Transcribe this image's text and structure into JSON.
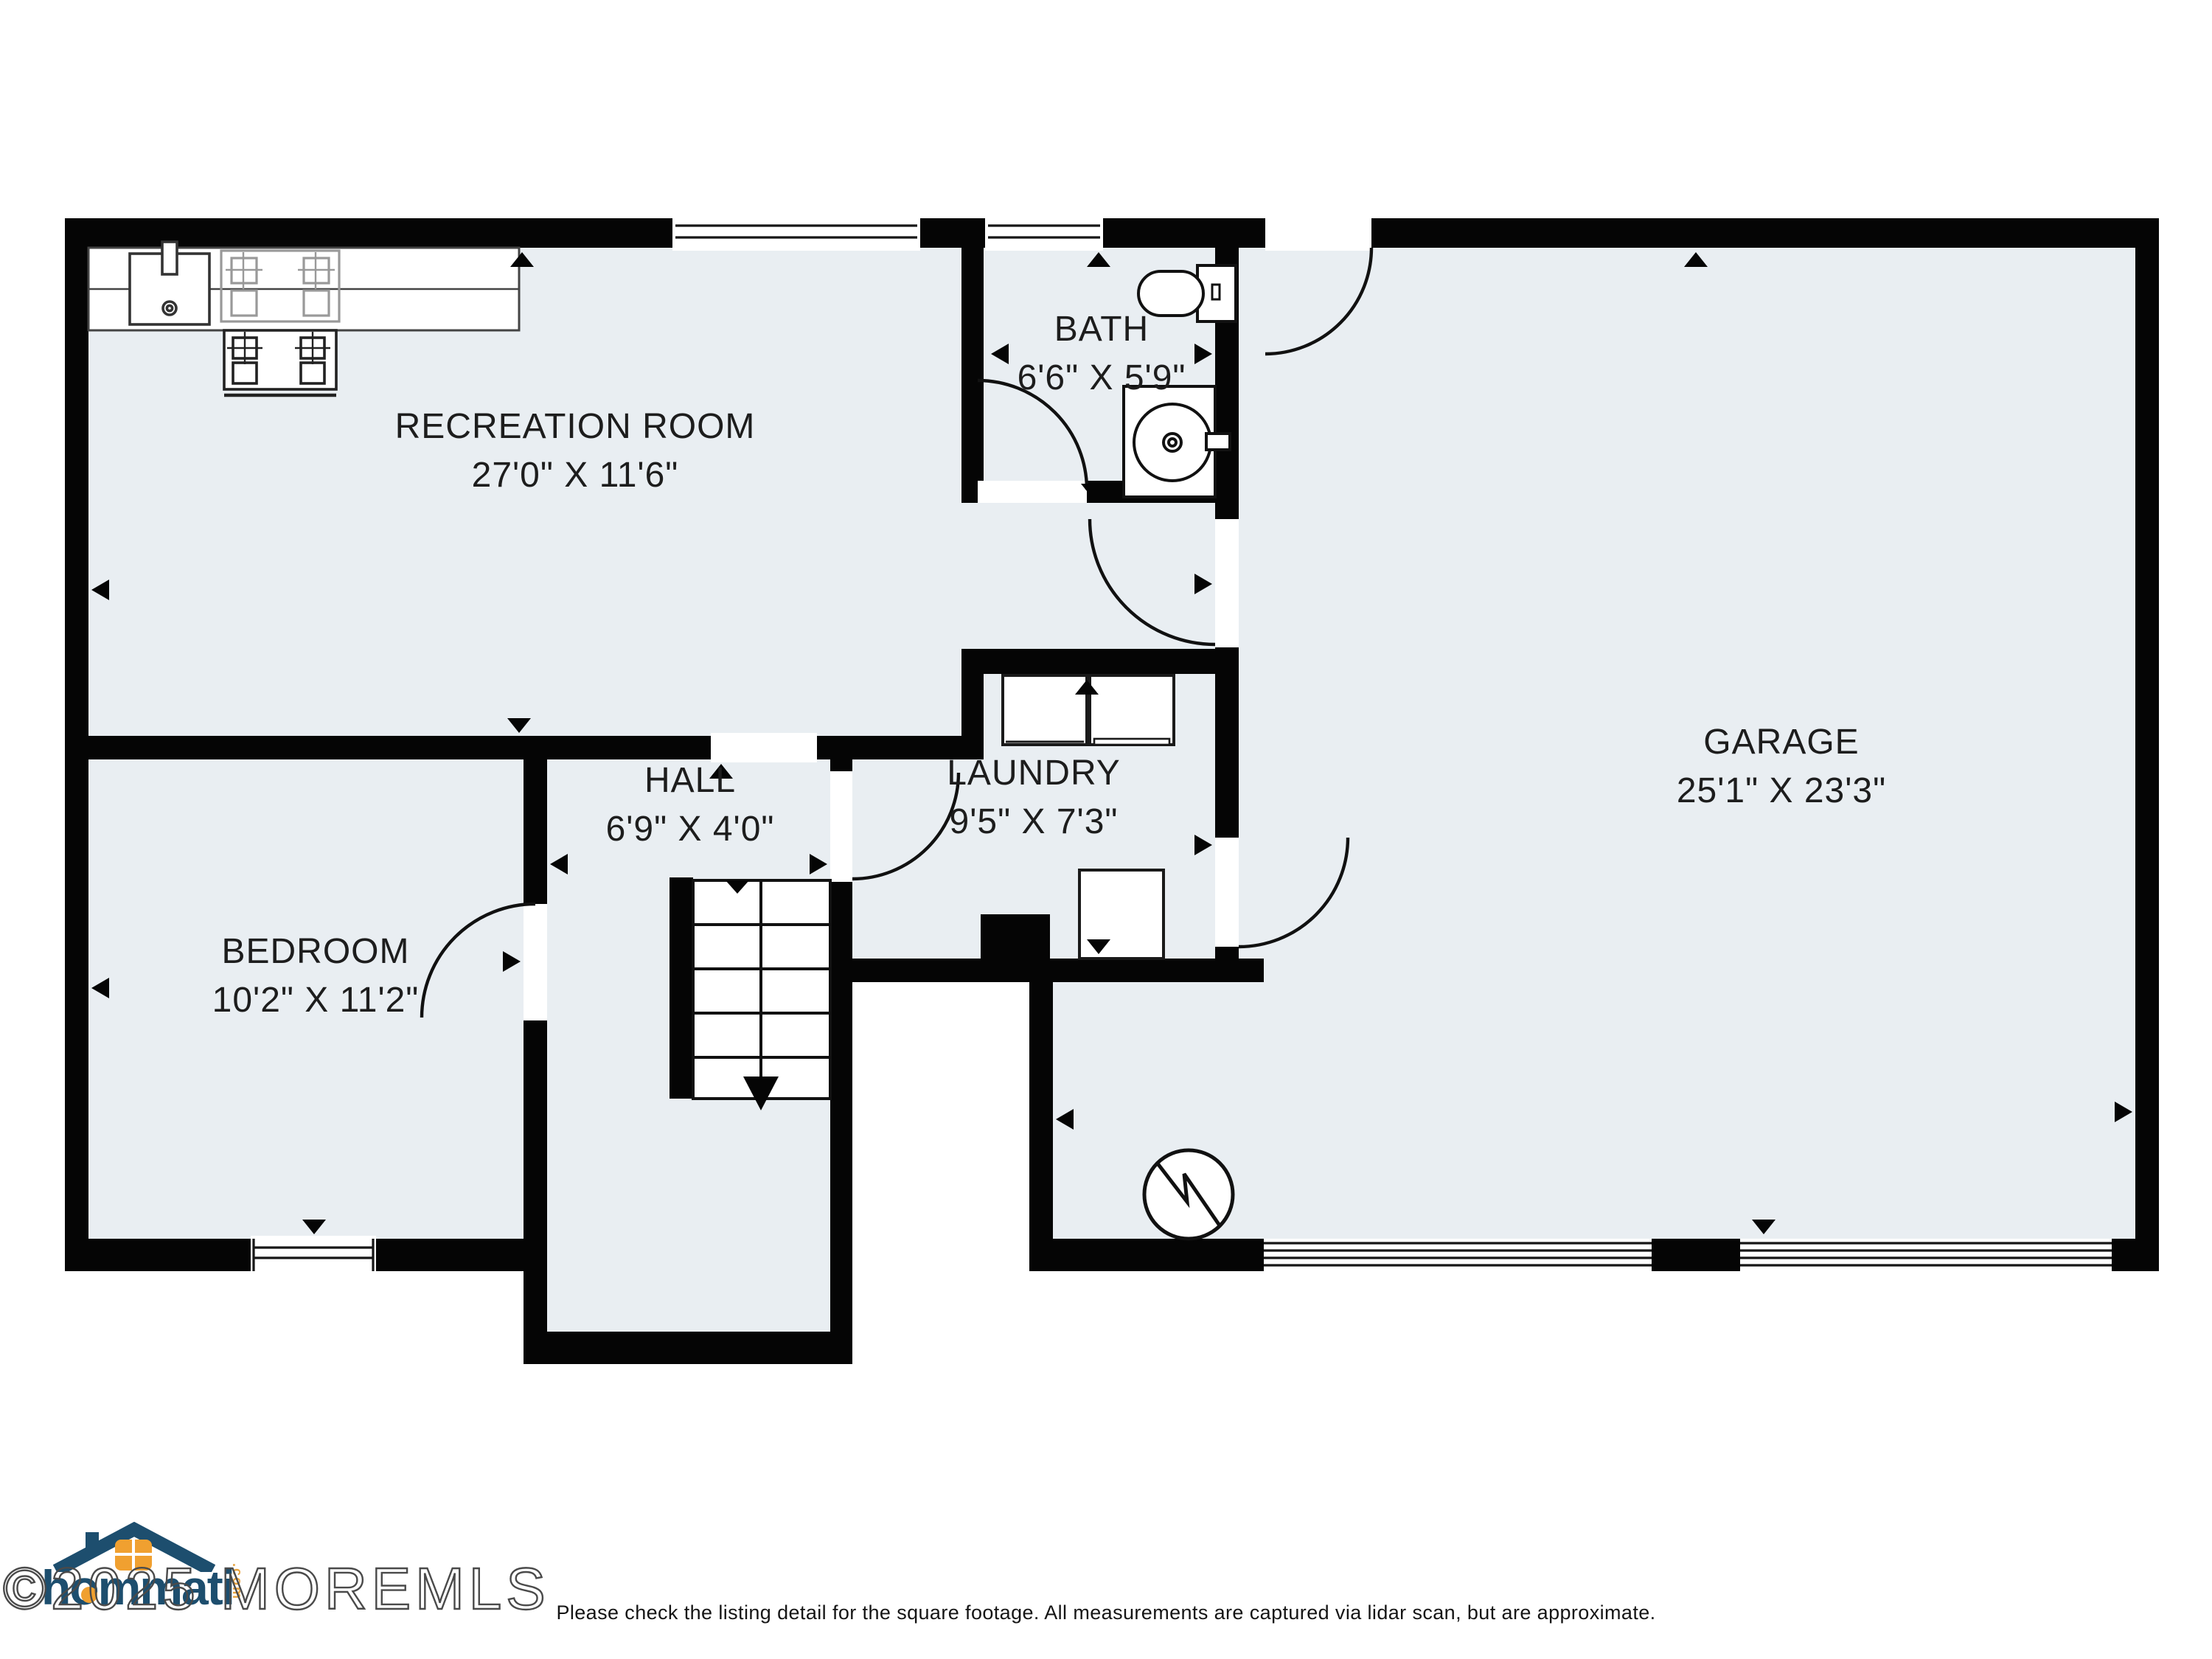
{
  "floorplan": {
    "rooms": [
      {
        "id": "recreation-room",
        "name": "RECREATION ROOM",
        "dims": "27'0\" X 11'6\""
      },
      {
        "id": "bath",
        "name": "BATH",
        "dims": "6'6\" X 5'9\""
      },
      {
        "id": "garage",
        "name": "GARAGE",
        "dims": "25'1\" X 23'3\""
      },
      {
        "id": "hall",
        "name": "HALL",
        "dims": "6'9\" X 4'0\""
      },
      {
        "id": "laundry",
        "name": "LAUNDRY",
        "dims": "9'5\" X 7'3\""
      },
      {
        "id": "bedroom",
        "name": "BEDROOM",
        "dims": "10'2\" X 11'2\""
      }
    ],
    "colors": {
      "floor": "#e9eef2",
      "wall": "#050505",
      "accent_navy": "#1d4e6e",
      "accent_orange": "#f0a030"
    }
  },
  "branding": {
    "logo_text": "hommati",
    "logo_tld": ".com",
    "watermark": "©2025 MOREMLS"
  },
  "footer": {
    "disclaimer": "Please check the listing detail for the square footage. All measurements are captured via lidar scan, but are approximate."
  }
}
